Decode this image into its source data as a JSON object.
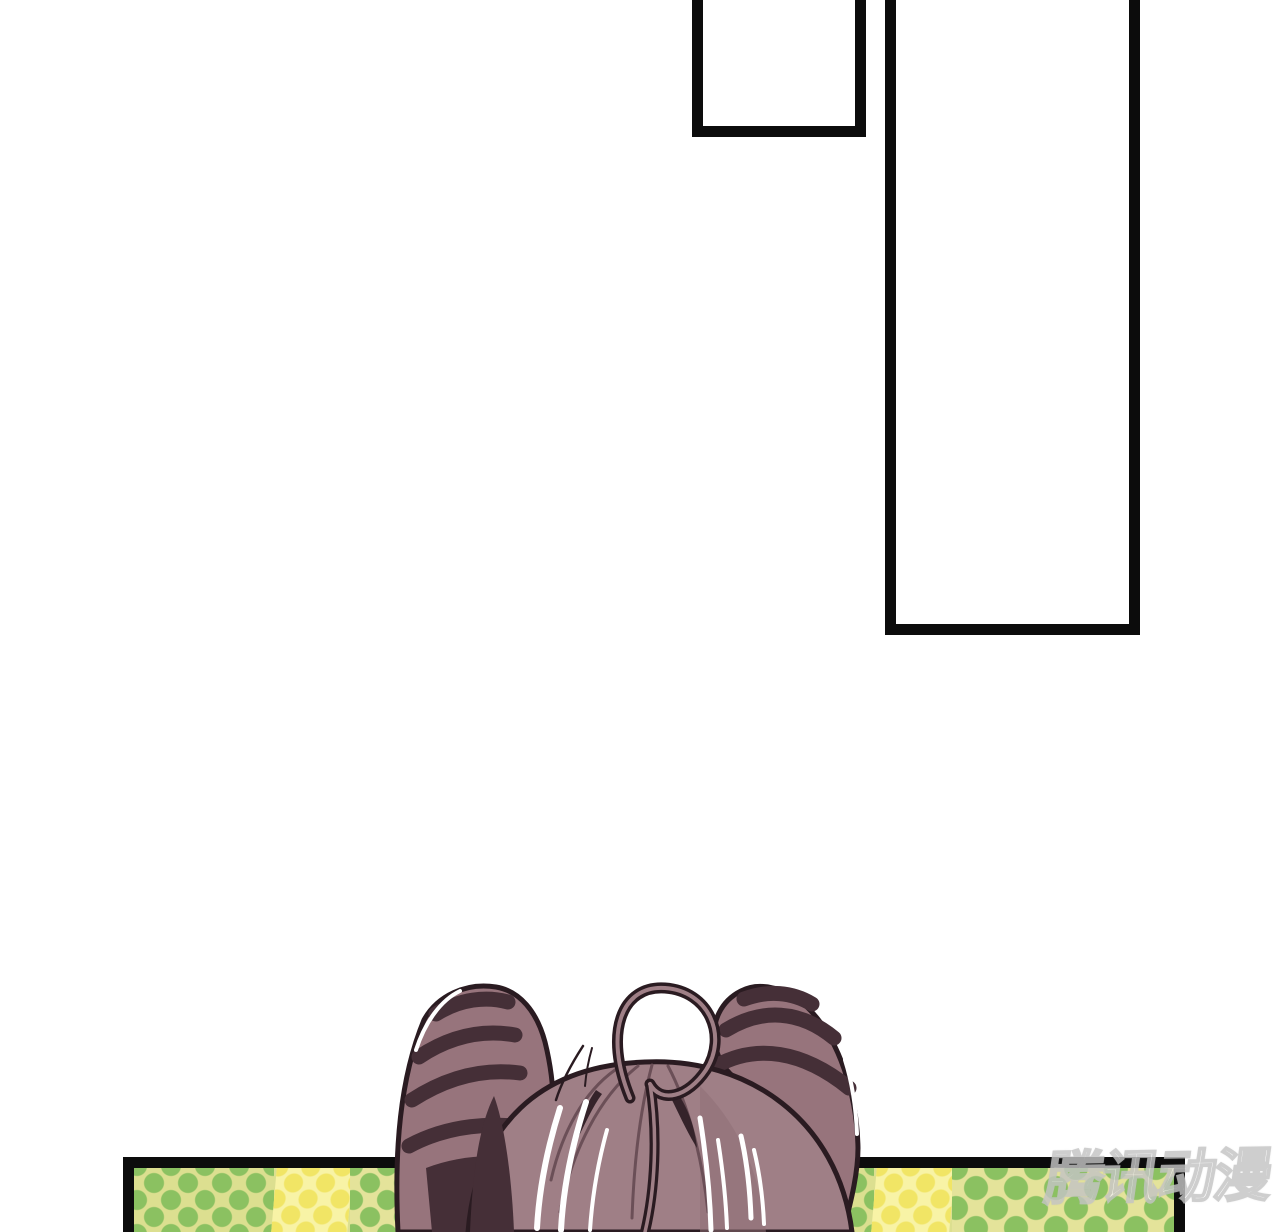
{
  "page": {
    "background": "#ffffff"
  },
  "watermark": {
    "text": "腾讯动漫"
  },
  "palette": {
    "panel_border": "#0c0c0c",
    "hair_base": "#9f7f86",
    "hair_rim": "#97747c",
    "hair_dark": "#452f37",
    "hair_darkest": "#2a1b21",
    "hair_highlight": "#ffffff",
    "dot_green": "#8bc161",
    "dot_green_bg": "#dcdf90",
    "dot_green_bg_pale": "#e4e39a",
    "dot_yellow": "#f1e565",
    "dot_yellow_bg": "#f8f3a6",
    "watermark_fill": "#ffffff",
    "watermark_outline": "#c4c4c4"
  }
}
